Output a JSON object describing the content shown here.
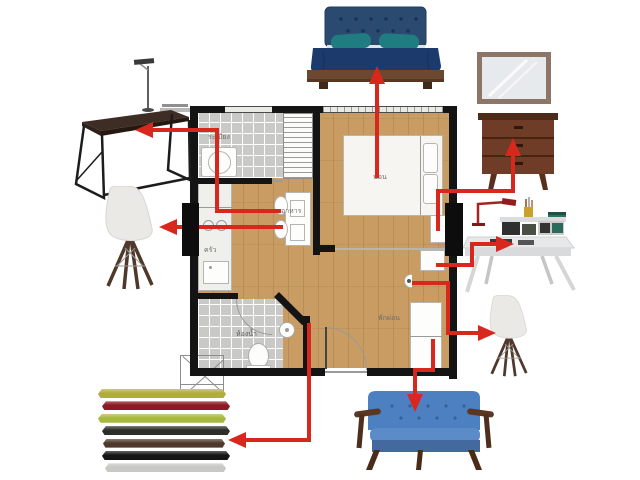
{
  "palette": {
    "arrow": "#d8281e",
    "wall": "#141414"
  },
  "plan": {
    "labels": {
      "balcony": "ระเบียง",
      "bedroom": "นอน",
      "dining": "อาหาร",
      "kitchen": "ครัว",
      "bathroom": "ห้องน้ำ",
      "living": "พักผ่อน"
    }
  },
  "furniture_items": [
    "dark-wood-console-desk",
    "white-eiffel-chair-left",
    "navy-platform-bed",
    "wall-mirror",
    "walnut-dresser",
    "white-study-desk",
    "white-eiffel-chair-right",
    "blue-wood-frame-loveseat",
    "colored-wall-shelves"
  ],
  "shelves": {
    "colors": [
      "#b0ad39",
      "#8c1a23",
      "#a6b83e",
      "#2e2e29",
      "#4e382c",
      "#151515",
      "#c8c8c5"
    ]
  },
  "arrows": [
    {
      "name": "arrow-to-bed",
      "points": [
        [
          377,
          178
        ],
        [
          377,
          80
        ]
      ]
    },
    {
      "name": "arrow-to-console",
      "points": [
        [
          281,
          211
        ],
        [
          217,
          211
        ],
        [
          217,
          130
        ],
        [
          149,
          130
        ]
      ]
    },
    {
      "name": "arrow-to-left-chair",
      "points": [
        [
          283,
          227
        ],
        [
          173,
          227
        ]
      ]
    },
    {
      "name": "arrow-to-dresser",
      "points": [
        [
          438,
          231
        ],
        [
          438,
          191
        ],
        [
          513,
          191
        ],
        [
          513,
          152
        ]
      ]
    },
    {
      "name": "arrow-to-desk",
      "points": [
        [
          436,
          265
        ],
        [
          472,
          265
        ],
        [
          472,
          244
        ],
        [
          500,
          244
        ]
      ]
    },
    {
      "name": "arrow-to-right-chair",
      "points": [
        [
          412,
          283
        ],
        [
          448,
          283
        ],
        [
          448,
          333
        ],
        [
          482,
          333
        ]
      ]
    },
    {
      "name": "arrow-to-sofa",
      "points": [
        [
          433,
          339
        ],
        [
          433,
          370
        ],
        [
          415,
          370
        ],
        [
          415,
          398
        ]
      ]
    },
    {
      "name": "arrow-to-shelves",
      "points": [
        [
          309,
          323
        ],
        [
          309,
          440
        ],
        [
          242,
          440
        ]
      ]
    }
  ]
}
